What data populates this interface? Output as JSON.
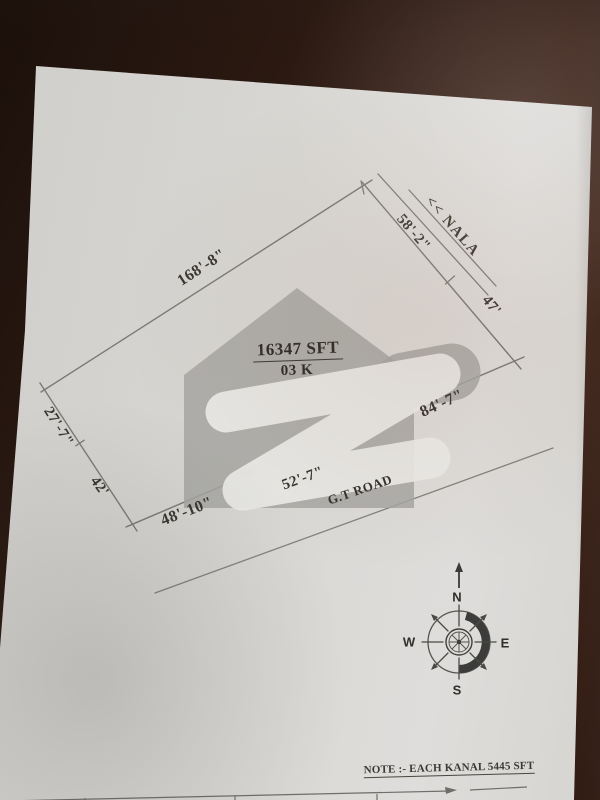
{
  "plot": {
    "area": "16347 SFT",
    "kanal": "03 K",
    "dimensions": {
      "top_left_edge": "168'-8\"",
      "upper_right_edge_1": "58'-2\"",
      "upper_right_edge_2": "47'",
      "right_edge": "84'-7\"",
      "bottom_edge_mid": "52'-7\"",
      "bottom_edge_left": "48'-10\"",
      "lower_left_edge_1": "27'-7\"",
      "lower_left_edge_2": "42'"
    },
    "nala_label": "<< NALA",
    "road_label": "G.T ROAD"
  },
  "compass": {
    "north": "N",
    "east": "E",
    "south": "S",
    "west": "W"
  },
  "note": "NOTE :- EACH KANAL 5445 SFT",
  "colors": {
    "background_wood": "#2c1a12",
    "paper": "#d6d5d1",
    "ink": "#38362f",
    "pencil_line": "#7b7a76",
    "watermark_gray": "#a6a6a2",
    "watermark_white": "#ebebe7"
  }
}
